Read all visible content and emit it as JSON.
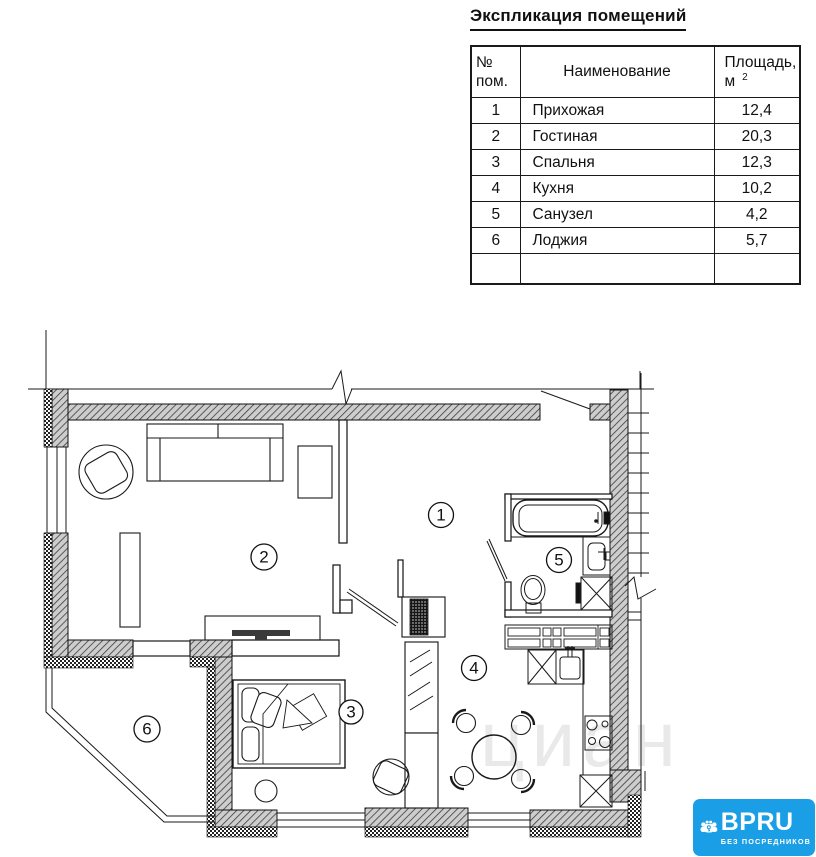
{
  "title": "Экспликация помещений",
  "table": {
    "headers": {
      "num_top": "№",
      "num_bottom": "пом.",
      "name": "Наименование",
      "area_top": "Площадь,",
      "area_unit": "м",
      "area_sup": "2"
    },
    "rows": [
      {
        "num": "1",
        "name": "Прихожая",
        "area": "12,4"
      },
      {
        "num": "2",
        "name": "Гостиная",
        "area": "20,3"
      },
      {
        "num": "3",
        "name": "Спальня",
        "area": "12,3"
      },
      {
        "num": "4",
        "name": "Кухня",
        "area": "10,2"
      },
      {
        "num": "5",
        "name": "Санузел",
        "area": "4,2"
      },
      {
        "num": "6",
        "name": "Лоджия",
        "area": "5,7"
      }
    ]
  },
  "plan": {
    "rooms": [
      {
        "number": "1"
      },
      {
        "number": "2"
      },
      {
        "number": "3"
      },
      {
        "number": "4"
      },
      {
        "number": "5"
      },
      {
        "number": "6"
      }
    ],
    "watermark": "циан"
  },
  "logo": {
    "brand": "BPRU",
    "tagline": "БЕЗ ПОСРЕДНИКОВ",
    "background_color": "#1a9fe6",
    "text_color": "#ffffff"
  },
  "colors": {
    "line": "#1a1a1a",
    "wall_hatch_bg": "#cdcdcd",
    "watermark_gray": "#6a6a6a"
  }
}
